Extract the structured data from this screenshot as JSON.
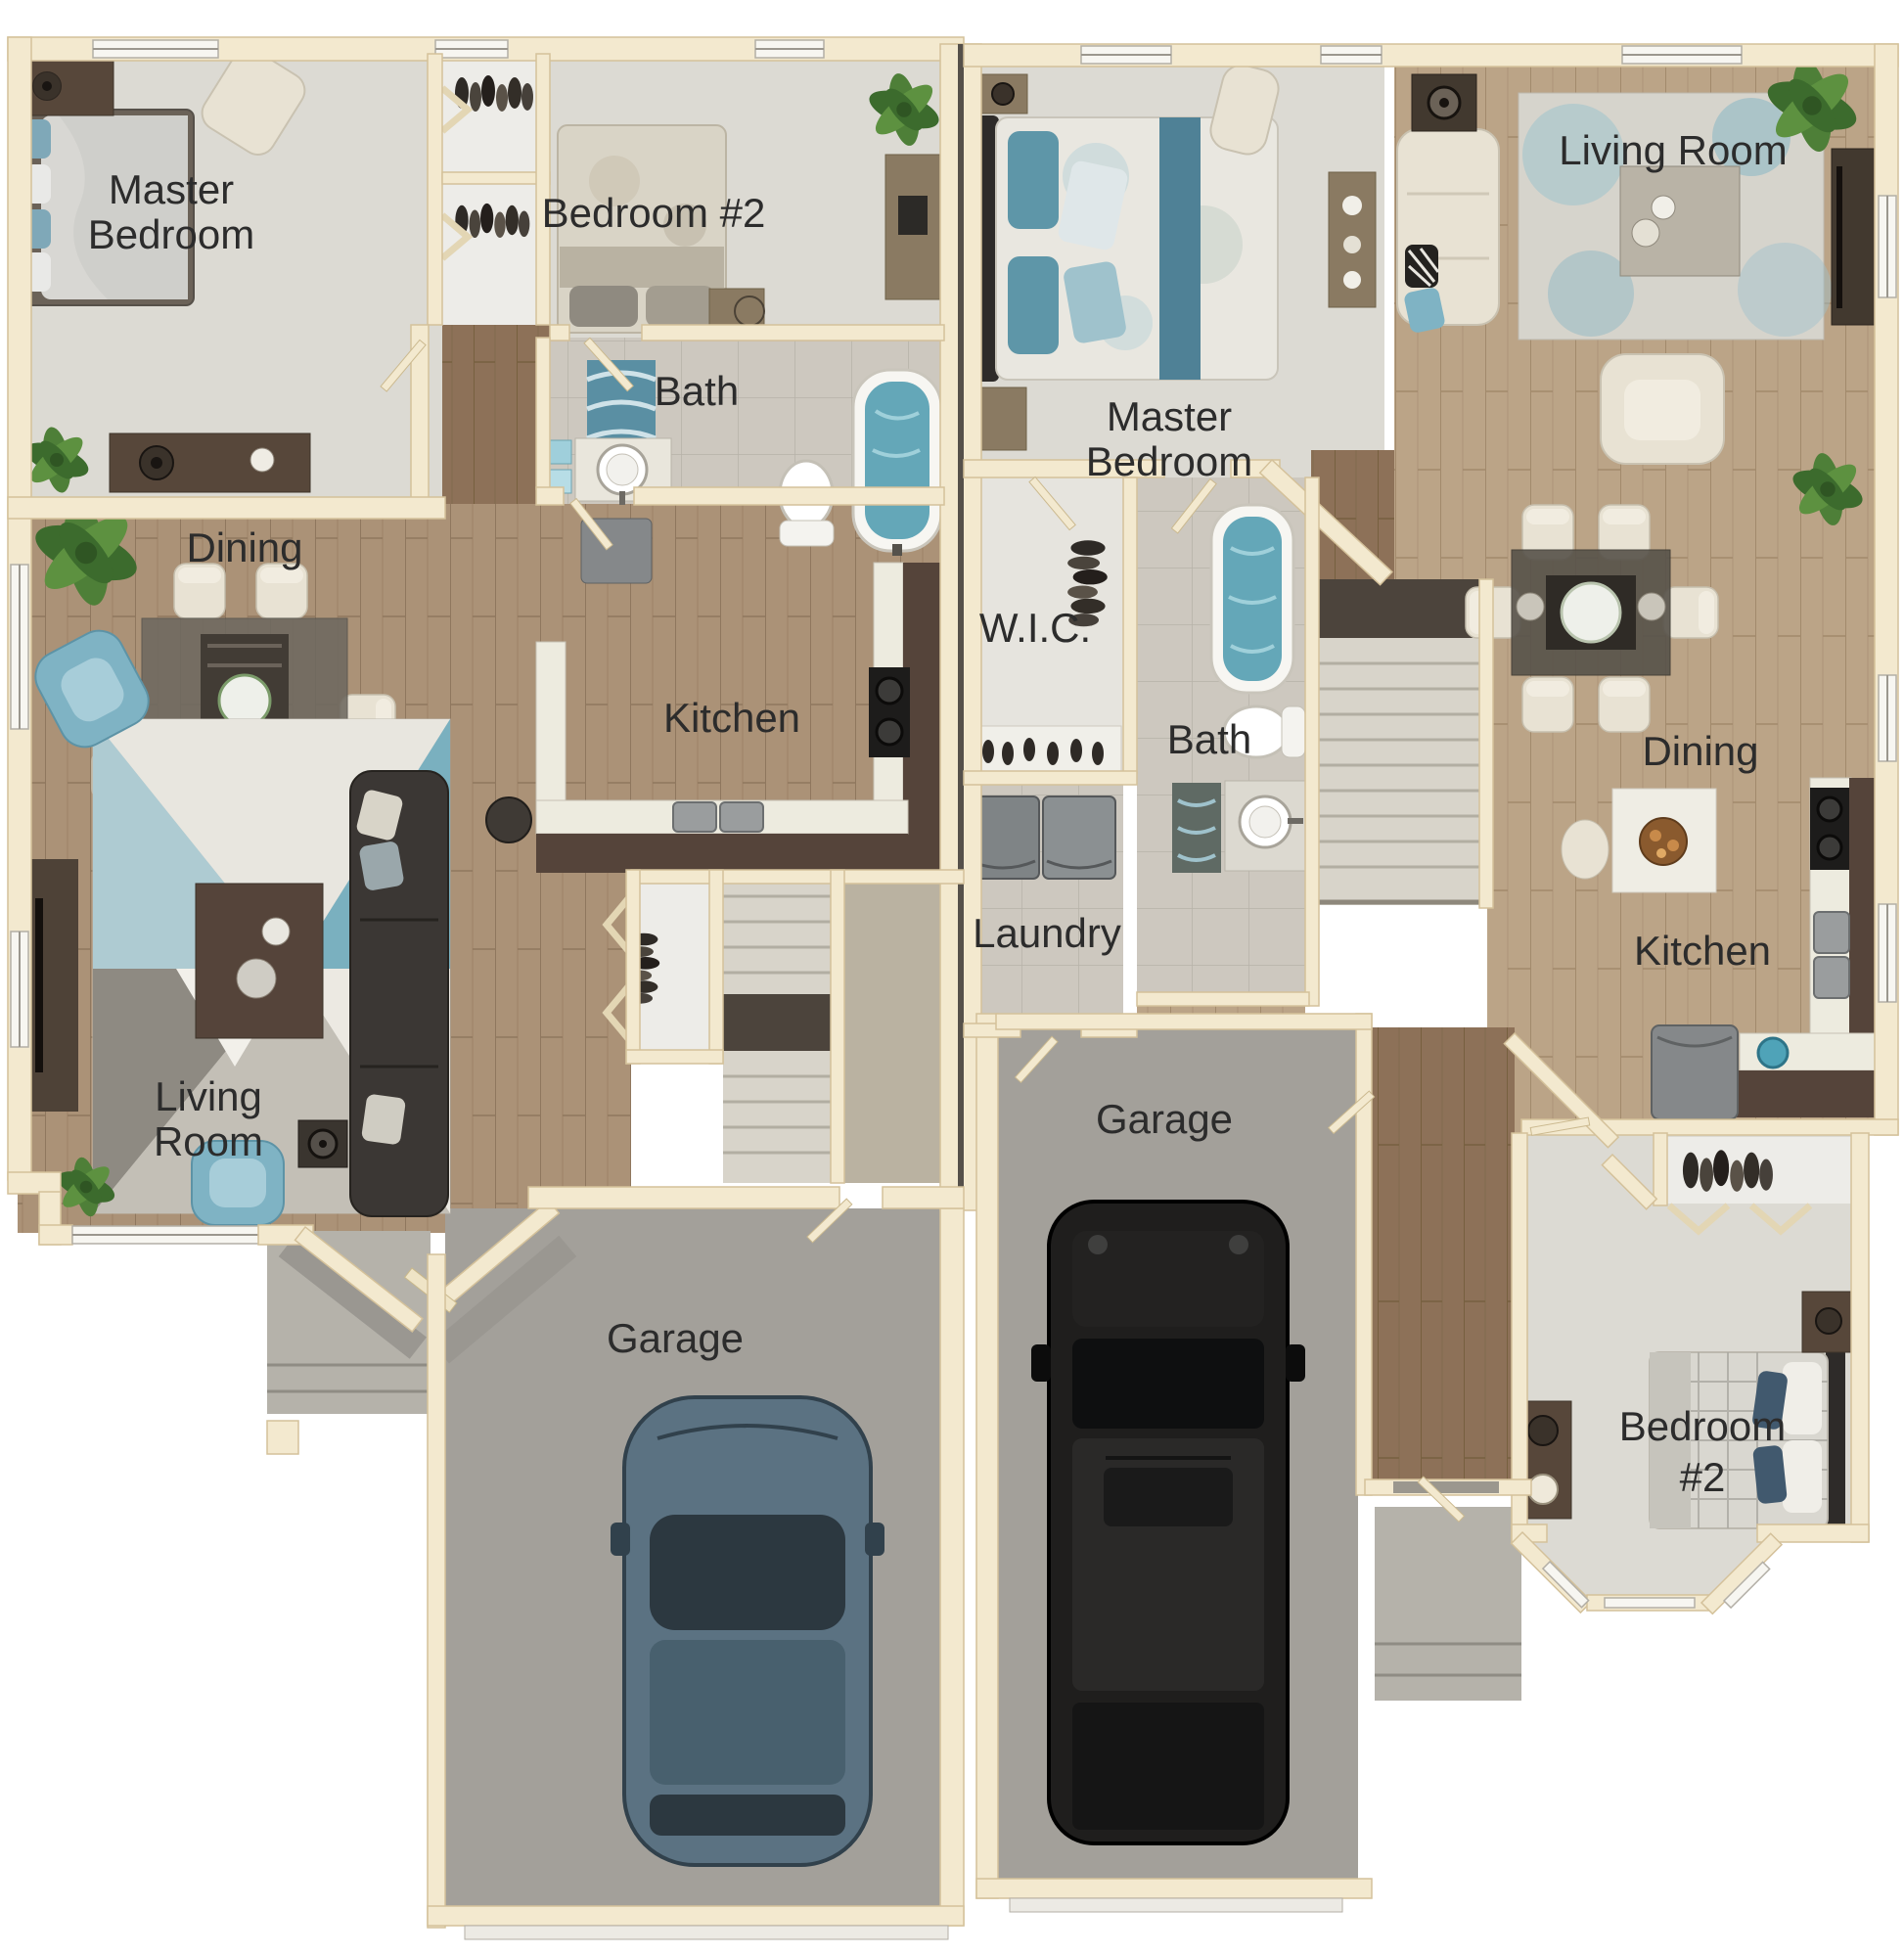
{
  "image_type": "duplex-floor-plan",
  "units": {
    "left": {
      "rooms": {
        "master_line1": "Master",
        "master_line2": "Bedroom",
        "bedroom2": "Bedroom #2",
        "bath": "Bath",
        "dining": "Dining",
        "kitchen": "Kitchen",
        "living_line1": "Living",
        "living_line2": "Room",
        "garage": "Garage"
      }
    },
    "right": {
      "rooms": {
        "master_line1": "Master",
        "master_line2": "Bedroom",
        "living": "Living Room",
        "wic": "W.I.C.",
        "bath": "Bath",
        "dining": "Dining",
        "laundry": "Laundry",
        "kitchen": "Kitchen",
        "garage": "Garage",
        "bedroom2_line1": "Bedroom",
        "bedroom2_line2": "#2"
      }
    }
  },
  "colors": {
    "wall": "#f3e9cf",
    "wall_edge": "#d4c19a",
    "wood_left": "#a9907488",
    "wood_left_base": "#ab9277",
    "wood_dark": "#8d7158",
    "wood_right": "#bba487",
    "carpet": "#dcdad3",
    "carpet_bright": "#e6e4de",
    "tile": "#cdc8bf",
    "closet_floor": "#edece8",
    "garage_floor": "#a3a09a",
    "porch": "#b5b2aa",
    "stairs": "#d8d4ca",
    "stair_dark": "#4c443c",
    "counter_dark": "#55443a",
    "countertop": "#edebdf",
    "water": "#64a7b8",
    "accent_teal": "#7fb3c4",
    "sofa_dark": "#3b3734",
    "furniture_cream": "#e8e2d3",
    "furniture_wood": "#8a7a62",
    "dark_wood_furn": "#57473a",
    "appliance": "#85888a",
    "rug_gray": "#d3d0c8",
    "vehicle_blue": "#5b7282",
    "vehicle_black": "#1f1e1d",
    "plant": "#4e7f38",
    "label": "#2c2c2c"
  }
}
